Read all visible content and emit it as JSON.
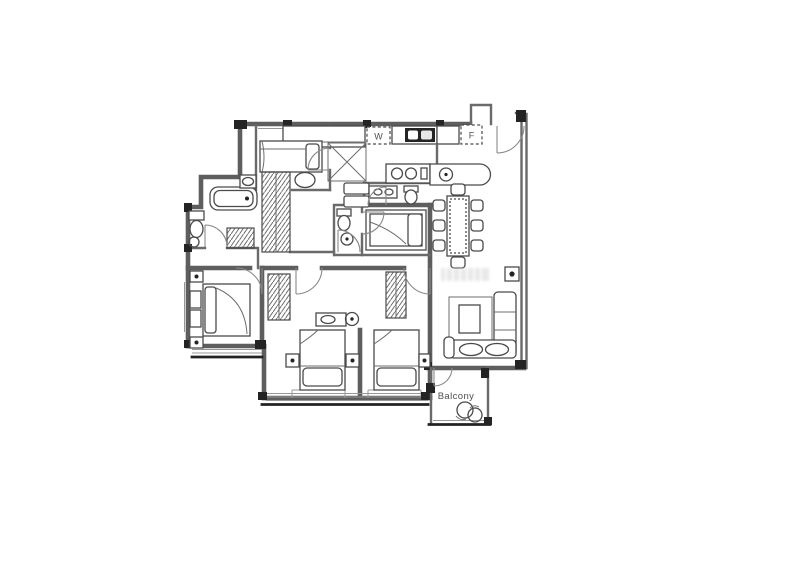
{
  "floor_plan": {
    "labels": {
      "washer": "W",
      "fridge": "F",
      "balcony": "Balcony"
    },
    "colors": {
      "background": "#ffffff",
      "wall": "#5e5e5e",
      "wall_dark": "#222222",
      "furniture_line": "#4a4a4a",
      "label_text": "#4f4f4f",
      "watermark": "#d7d7d7"
    }
  }
}
